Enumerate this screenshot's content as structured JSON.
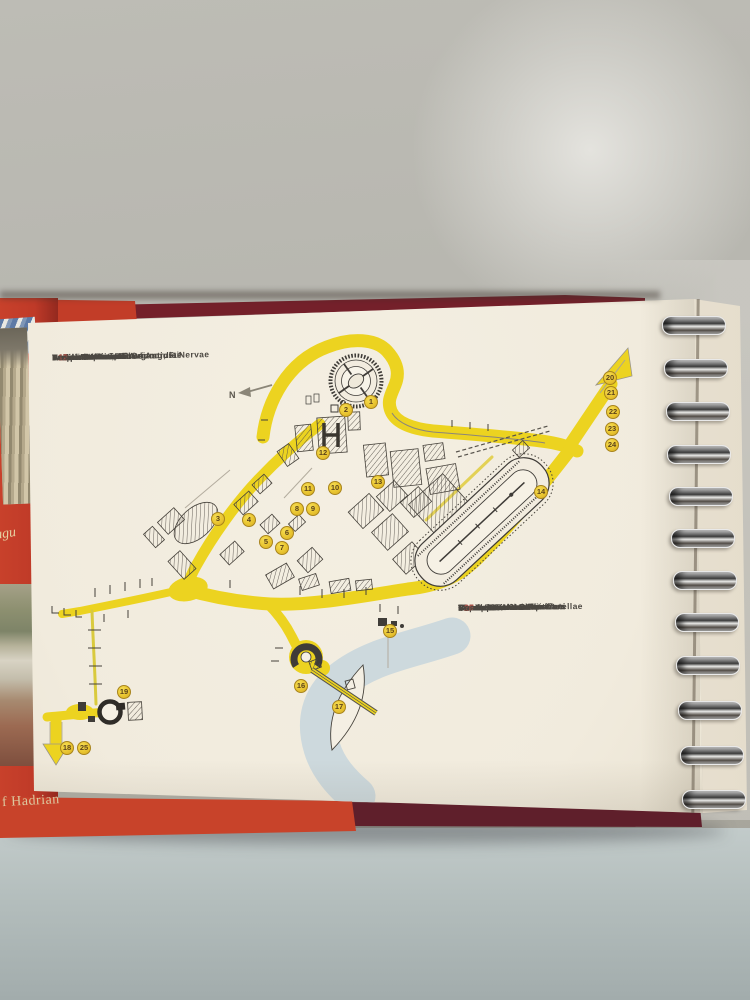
{
  "cover": {
    "bottom_text": "f Hadrian",
    "side_text_fragment": "augu"
  },
  "compass": {
    "label": "N"
  },
  "legend_left": {
    "items": [
      {
        "n": "1",
        "label": "Amphitheatrum Flavium"
      },
      {
        "n": "2",
        "label": "Vallis Amphitheatri"
      },
      {
        "n": "3",
        "label": "Forum Traiani, F. Augusti, F. Nervae"
      },
      {
        "n": "4",
        "label": "Forum Iulium"
      },
      {
        "n": "5",
        "label": "Forum Romanum"
      },
      {
        "n": "6",
        "label": "Forum"
      },
      {
        "n": "7",
        "label": "Aedes Saturni, A. Concordiae"
      },
      {
        "n": "8",
        "label": "Templum Divi Iulii"
      },
      {
        "n": "9",
        "label": "Aedes Vestae, Arcus Augusti"
      },
      {
        "n": "10",
        "label": "Atrium Vestae"
      },
      {
        "n": "11",
        "label": "Templum Divi Romuli"
      },
      {
        "n": "12",
        "label": "Basilica Maxentii"
      }
    ]
  },
  "legend_right": {
    "items": [
      {
        "n": "13",
        "label": "Mons Palatinus"
      },
      {
        "n": "14",
        "label": "Circus Maximus"
      },
      {
        "n": "15",
        "label": "Forum Boarium"
      },
      {
        "n": "16",
        "label": "Theatrum Marcelli"
      },
      {
        "n": "17",
        "label": "Insula inter duos pontes"
      },
      {
        "n": "18",
        "label": "Mausoleum Hadriani"
      },
      {
        "n": "19",
        "label": "Pantheon"
      },
      {
        "n": "20",
        "label": "Via Appia"
      },
      {
        "n": "21",
        "label": "Sepulcrum Ceciliae Metellae"
      },
      {
        "n": "22",
        "label": "Coemeterium Callisti"
      },
      {
        "n": "23",
        "label": "Coemeterium Domitillae"
      },
      {
        "n": "24",
        "label": "Coemeterium Sebastiani"
      },
      {
        "n": "25",
        "label": "Basilica Sancti Petri"
      }
    ]
  },
  "map_markers": [
    {
      "n": "1",
      "x": 371,
      "y": 402
    },
    {
      "n": "2",
      "x": 346,
      "y": 410
    },
    {
      "n": "3",
      "x": 218,
      "y": 519
    },
    {
      "n": "4",
      "x": 249,
      "y": 520
    },
    {
      "n": "5",
      "x": 266,
      "y": 542
    },
    {
      "n": "6",
      "x": 287,
      "y": 533
    },
    {
      "n": "7",
      "x": 282,
      "y": 548
    },
    {
      "n": "8",
      "x": 297,
      "y": 509
    },
    {
      "n": "9",
      "x": 313,
      "y": 509
    },
    {
      "n": "10",
      "x": 335,
      "y": 488
    },
    {
      "n": "11",
      "x": 308,
      "y": 489
    },
    {
      "n": "12",
      "x": 323,
      "y": 453
    },
    {
      "n": "13",
      "x": 378,
      "y": 482
    },
    {
      "n": "14",
      "x": 541,
      "y": 492
    },
    {
      "n": "15",
      "x": 390,
      "y": 631
    },
    {
      "n": "16",
      "x": 301,
      "y": 686
    },
    {
      "n": "17",
      "x": 339,
      "y": 707
    },
    {
      "n": "18",
      "x": 67,
      "y": 748
    },
    {
      "n": "19",
      "x": 124,
      "y": 692
    },
    {
      "n": "20",
      "x": 610,
      "y": 378
    },
    {
      "n": "21",
      "x": 611,
      "y": 393
    },
    {
      "n": "22",
      "x": 613,
      "y": 412
    },
    {
      "n": "23",
      "x": 612,
      "y": 429
    },
    {
      "n": "24",
      "x": 612,
      "y": 445
    },
    {
      "n": "25",
      "x": 84,
      "y": 748
    }
  ],
  "colors": {
    "road_yellow": "#ecd320",
    "river_blue": "#cdd9dd",
    "marker_yellow": "#e9c531",
    "cover_red": "#c23d28",
    "cover_maroon": "#6e2230",
    "legend_number_red": "#a5544a",
    "ink": "#45413a"
  }
}
